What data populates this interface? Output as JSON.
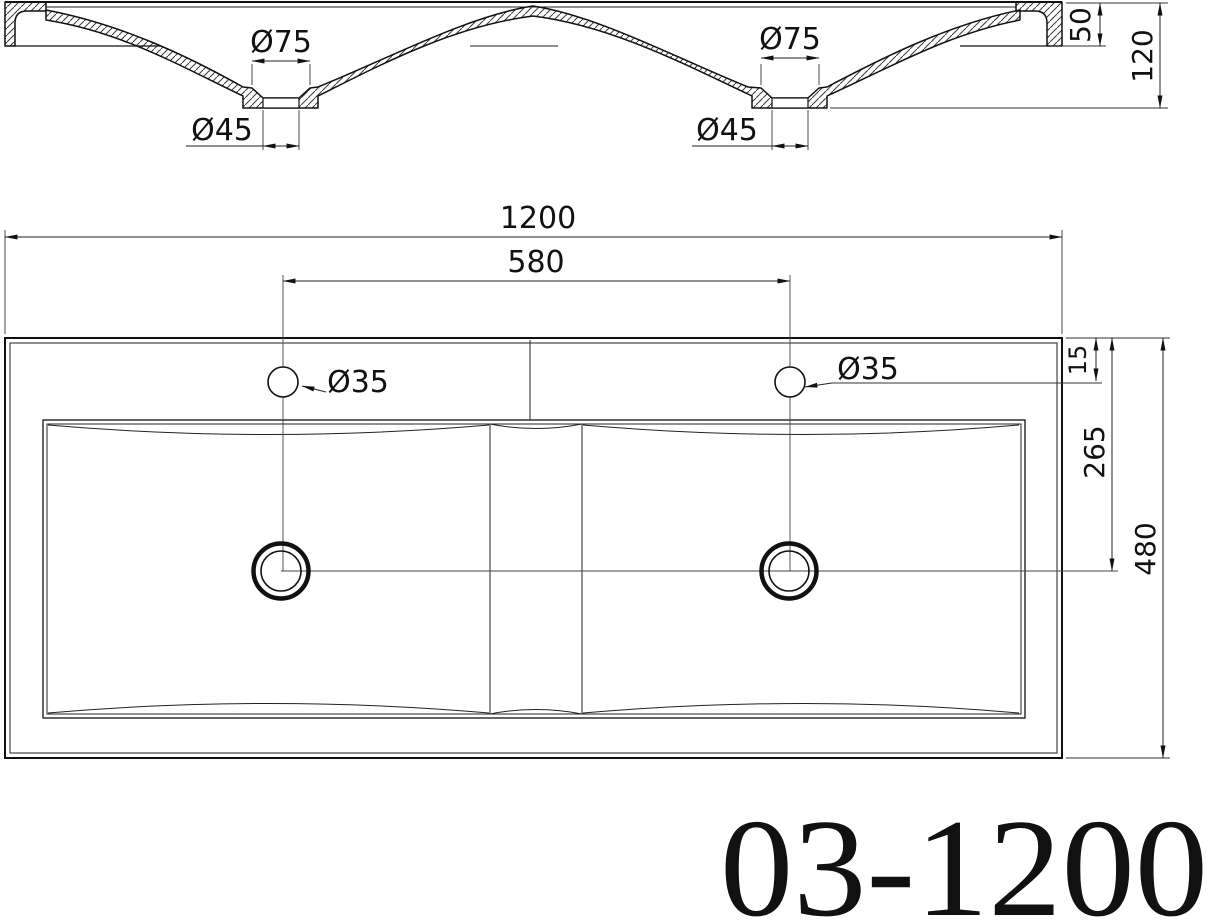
{
  "drawing_number": "03-1200",
  "section_view": {
    "label": "front-section-view",
    "dimensions": {
      "drain_countersink_left": "Ø75",
      "drain_countersink_right": "Ø75",
      "drain_hole_left": "Ø45",
      "drain_hole_right": "Ø45",
      "front_edge_height": "50",
      "overall_height": "120"
    }
  },
  "plan_view": {
    "label": "top-plan-view",
    "dimensions": {
      "overall_width": "1200",
      "faucet_hole_spacing": "580",
      "faucet_hole_left": "Ø35",
      "faucet_hole_right": "Ø35",
      "back_edge_to_faucet_line": "15",
      "back_edge_to_drain_center": "265",
      "overall_depth": "480"
    }
  },
  "colors": {
    "line": "#111111",
    "background": "#ffffff"
  }
}
